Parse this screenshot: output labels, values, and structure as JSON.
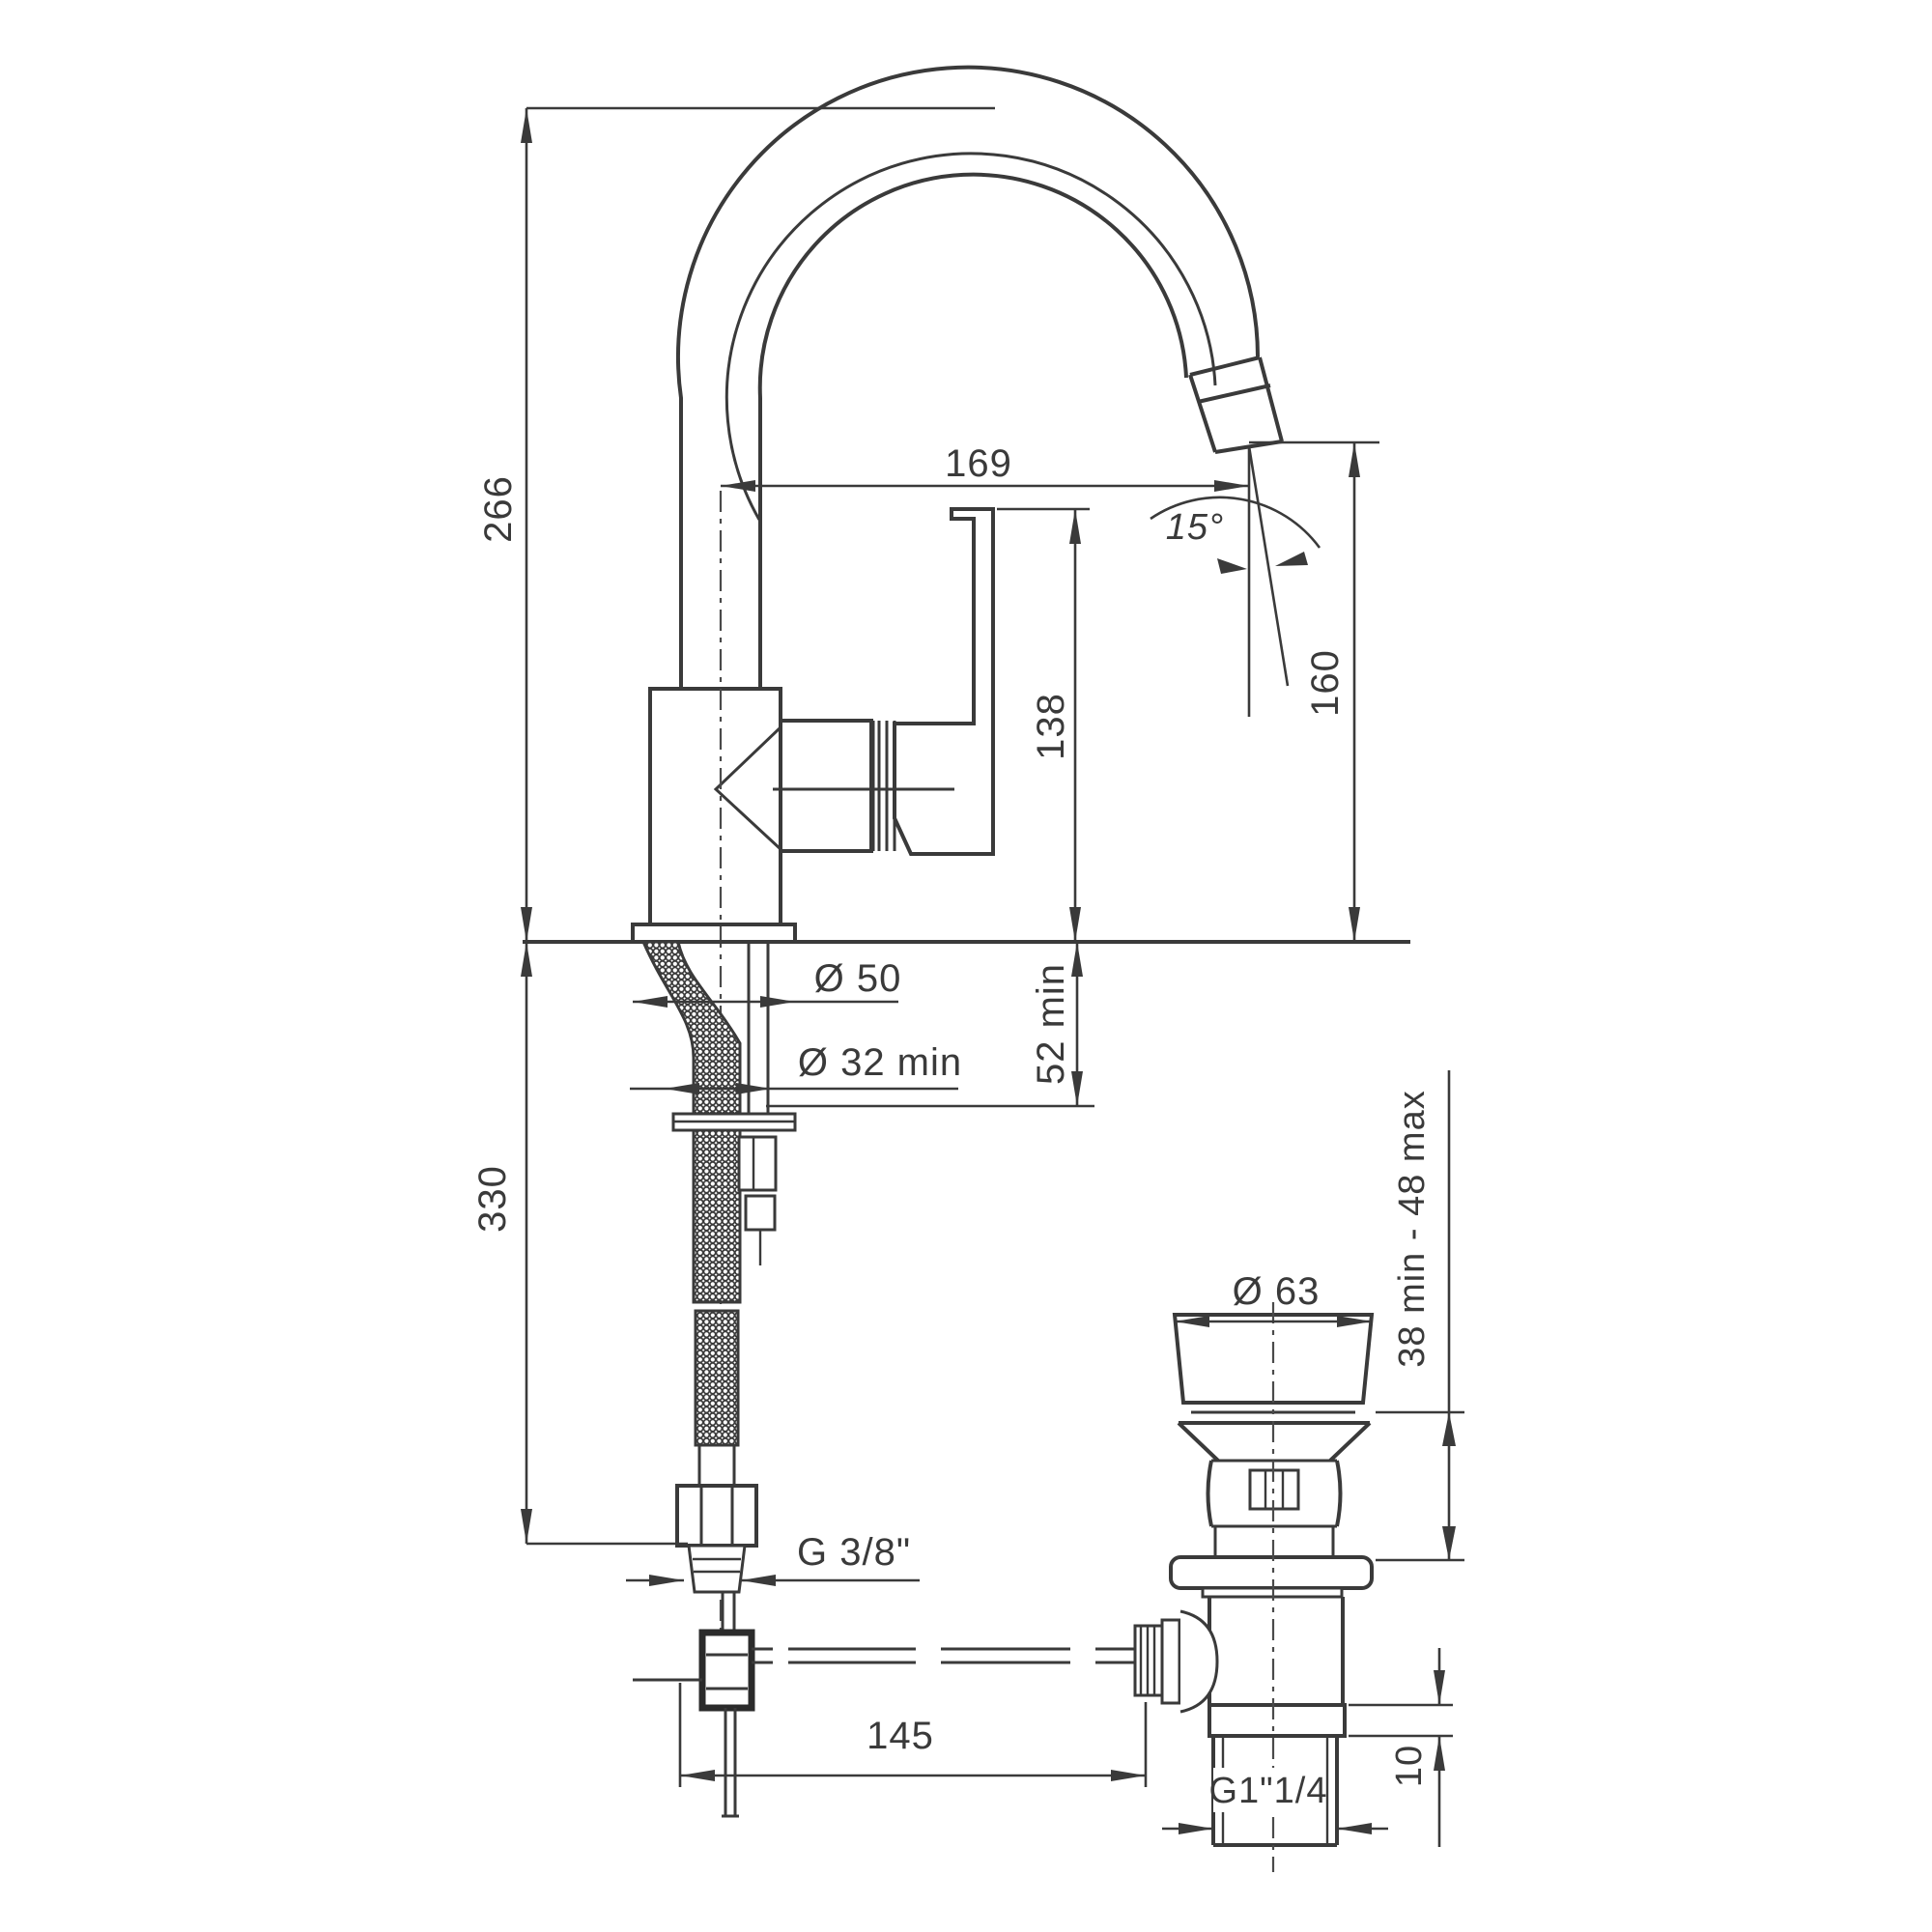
{
  "drawing": {
    "type": "technical-dimension-drawing",
    "subject": "single-lever basin mixer tap with swivel gooseneck spout, flexible supply hose and pop-up waste drain",
    "units": "mm",
    "line_color": "#3a3a3a",
    "background": "#ffffff",
    "dimensions": {
      "overall_height": "266",
      "spout_reach": "169",
      "spout_angle": "15°",
      "outlet_height": "160",
      "handle_height": "138",
      "base_diameter": "Ø 50",
      "mounting_hole": "Ø 32 min",
      "deck_thickness": "52 min",
      "hose_drop": "330",
      "supply_thread": "G 3/8\"",
      "rod_offset": "145",
      "waste_flange_diameter": "Ø 63",
      "basin_thickness_range": "38 min - 48 max",
      "waste_thread": "G1\"1/4",
      "locknut_height": "10"
    }
  }
}
